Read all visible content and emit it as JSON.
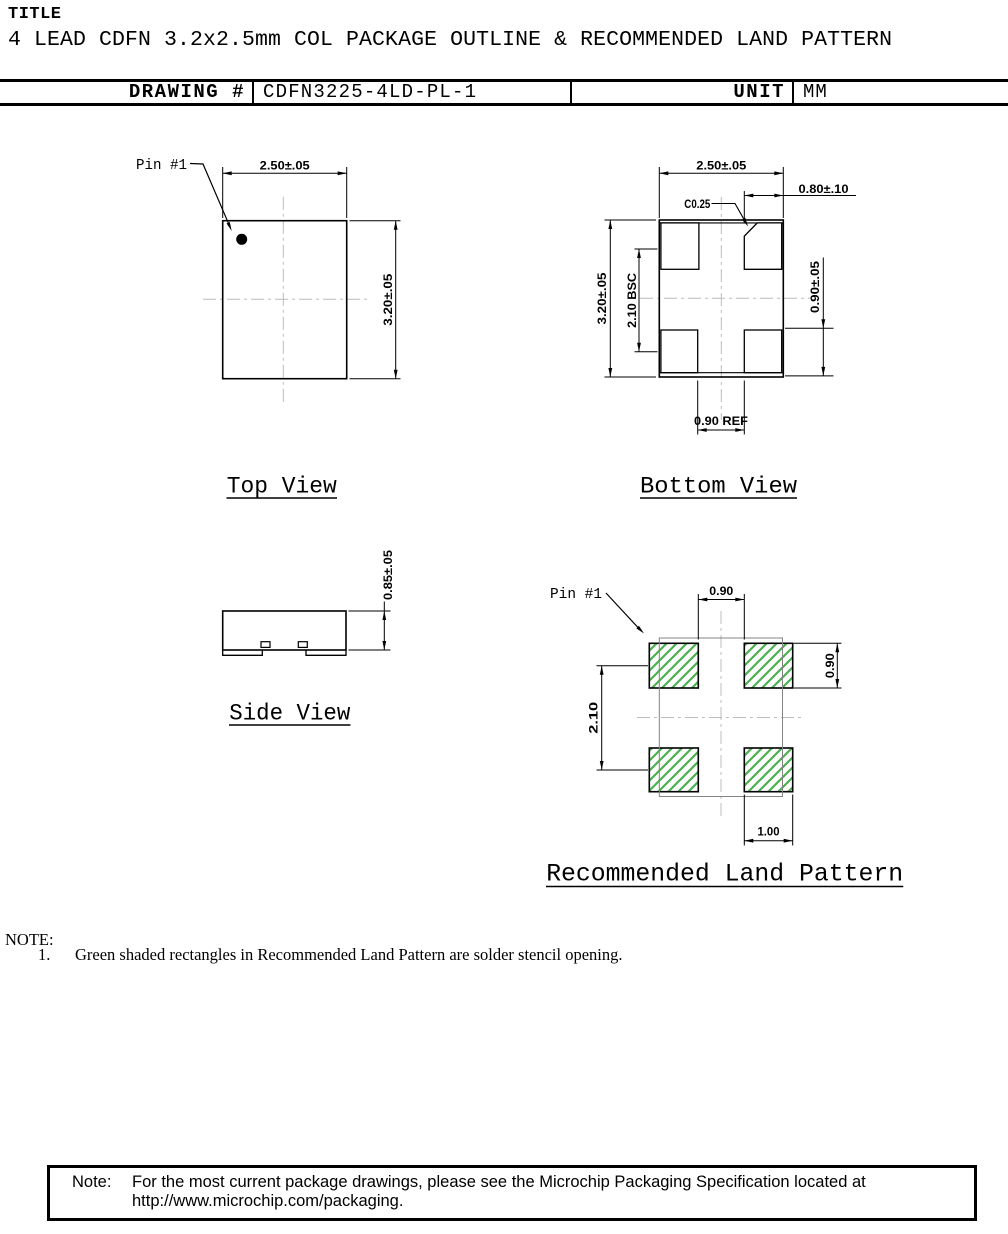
{
  "header": {
    "title_label": "TITLE",
    "title": "4 LEAD CDFN 3.2x2.5mm COL PACKAGE OUTLINE & RECOMMENDED LAND PATTERN",
    "drawing_number_label": "DRAWING #",
    "drawing_number": "CDFN3225-4LD-PL-1",
    "unit_label": "UNIT",
    "unit": "MM"
  },
  "views": {
    "top": {
      "title": "Top View",
      "pin1_label": "Pin #1",
      "dim_width": "2.50±.05",
      "dim_height": "3.20±.05"
    },
    "bottom": {
      "title": "Bottom View",
      "dim_width": "2.50±.05",
      "dim_height": "3.20±.05",
      "dim_lead_width": "0.80±.10",
      "dim_chamfer": "C0.25",
      "dim_pitch": "2.10 BSC",
      "dim_lead_height": "0.90±.05",
      "dim_center_gap": "0.90 REF"
    },
    "side": {
      "title": "Side View",
      "dim_height": "0.85±.05"
    },
    "land": {
      "title": "Recommended Land Pattern",
      "pin1_label": "Pin #1",
      "dim_gap_x": "0.90",
      "dim_pad_height": "0.90",
      "dim_pitch_y": "2.10",
      "dim_pad_width": "1.00"
    }
  },
  "note": {
    "heading": "NOTE:",
    "item_number": "1.",
    "item_text": "Green shaded rectangles in Recommended Land Pattern are solder stencil opening."
  },
  "footer": {
    "note_label": "Note:",
    "line1": "For the most current package drawings, please see the Microchip Packaging Specification located at",
    "line2": "http://www.microchip.com/packaging."
  },
  "colors": {
    "line_black": "#000000",
    "stencil_green": "#4bb04f",
    "phantom_gray": "#848484",
    "centerline_gray": "#bcbcbc"
  }
}
